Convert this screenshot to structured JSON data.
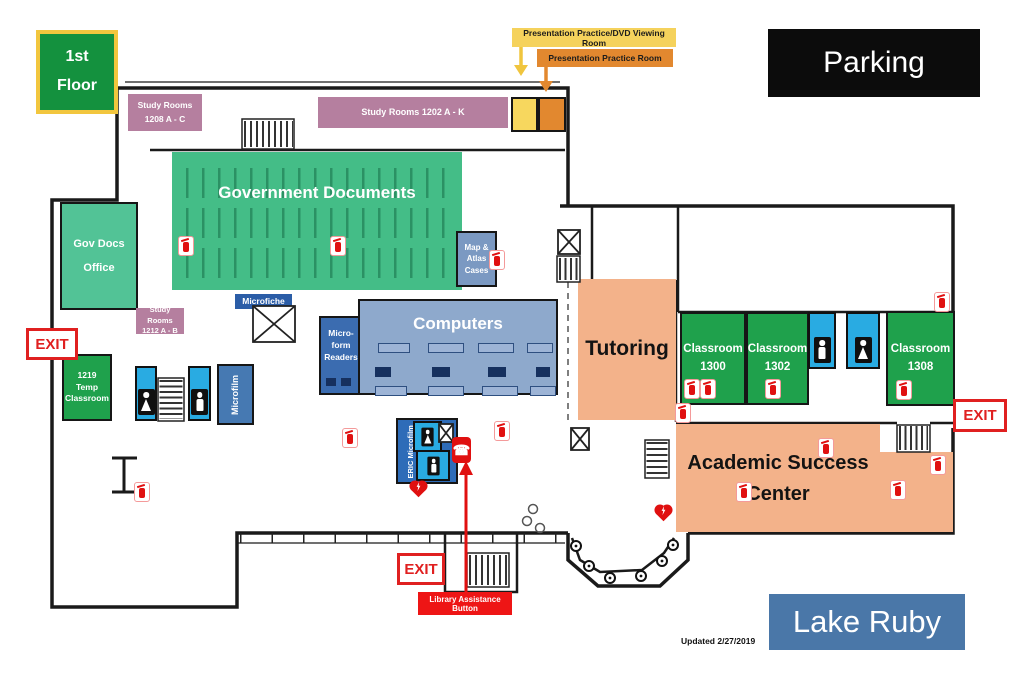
{
  "badges": {
    "floor": "1st\nFloor",
    "parking": "Parking",
    "lake": "Lake Ruby"
  },
  "callouts": {
    "presentation_dvd": "Presentation Practice/DVD Viewing Room",
    "presentation_practice": "Presentation Practice Room",
    "library_assistance": "Library Assistance Button"
  },
  "exits": {
    "left": "EXIT",
    "bottom": "EXIT",
    "right": "EXIT"
  },
  "rooms": {
    "study_1208": "Study Rooms\n1208 A - C",
    "study_1202": "Study Rooms 1202 A - K",
    "gov_docs": "Government Documents",
    "gov_docs_office": "Gov Docs\nOffice",
    "study_1212": "Study Rooms\n1212 A - B",
    "temp_1219": "1219\nTemp\nClassroom",
    "microfiche": "Microfiche",
    "microform": "Micro-\nform\nReaders",
    "computers": "Computers",
    "map_atlas": "Map &\nAtlas\nCases",
    "microfilm": "Microfilm",
    "eric": "ERIC Microfilm",
    "tutoring": "Tutoring",
    "class_1300": "Classroom\n1300",
    "class_1302": "Classroom\n1302",
    "class_1308": "Classroom\n1308",
    "asc": "Academic Success Center"
  },
  "annotations": {
    "updated": "Updated 2/27/2019"
  },
  "icons": {
    "fire_extinguisher": "fire-extinguisher-icon",
    "restroom_women": "women-restroom-icon",
    "restroom_men": "men-restroom-icon",
    "aed": "aed-heart-icon",
    "assistance_phone": "assistance-phone-icon",
    "stairs": "stairs-symbol",
    "elevator": "elevator-symbol"
  },
  "colors": {
    "classroom_green": "#1fa14c",
    "govdocs_green": "#44bd87",
    "office_green": "#52c396",
    "study_pink": "#b57f9f",
    "restroom_cyan": "#29abe2",
    "microfiche_blue": "#2b5da7",
    "microform_blue": "#3b6cb0",
    "computers_blue": "#8ea9cc",
    "map_slate": "#7b99c2",
    "microfilm_steel": "#4679b2",
    "peach": "#f3b28a",
    "callout_yellow": "#f5d25c",
    "callout_orange": "#e2882f",
    "exit_red": "#e02020",
    "lake_blue": "#4a77a8",
    "parking_black": "#0c0c0c",
    "floor_badge_green": "#14913e",
    "floor_badge_border": "#f2c63e"
  }
}
